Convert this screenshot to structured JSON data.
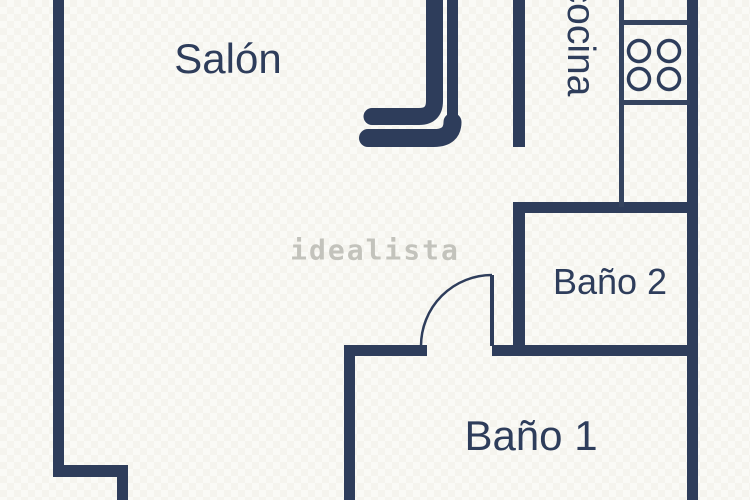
{
  "plan": {
    "background_color": "#f8f7f1",
    "wall_color": "#2e3d5b",
    "watermark": {
      "text": "idealista",
      "color": "#c3c3bc"
    },
    "rooms": {
      "salon": {
        "label": "Salón"
      },
      "cocina": {
        "label": "cocina",
        "orientation": "rotated-90"
      },
      "bano2": {
        "label": "Baño 2"
      },
      "bano1": {
        "label": "Baño 1"
      }
    },
    "icons": {
      "stove": "stove-burners-icon"
    }
  }
}
